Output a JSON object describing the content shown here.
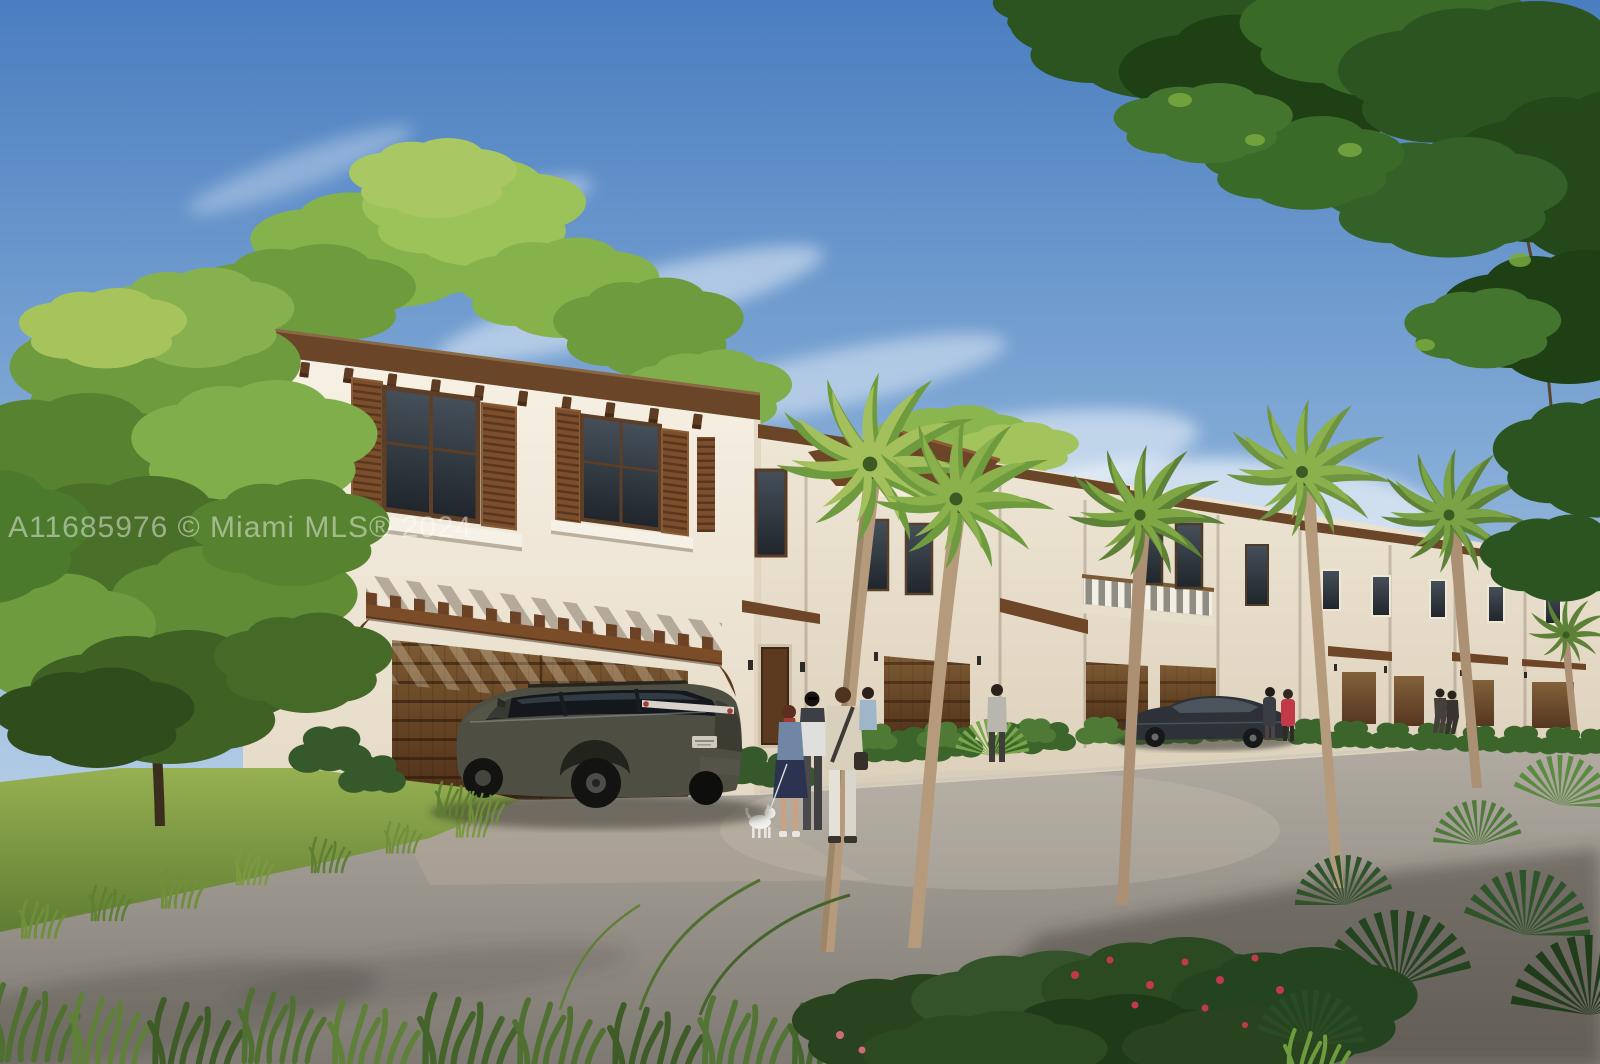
{
  "image": {
    "kind": "real-estate architectural rendering photo",
    "width": 1600,
    "height": 1064,
    "description": "Sunny rendering of a row of two-story Mediterranean-style townhouses with brown shutters, wood pergola over double garage, palm trees, a dark olive SUV parked in the driveway, a group of people with a small white dog, a dark sedan parked further down, green lawn and road in the foreground framed by trees and tropical plants."
  },
  "watermark": {
    "text": "A11685976 © Miami MLS® 2024",
    "color": "#ffffff",
    "opacity": 0.45
  },
  "palette": {
    "sky_top": "#4a7ec0",
    "sky_mid": "#93b7dc",
    "sky_horizon": "#dbe7f1",
    "wall_light": "#f7f1e5",
    "wall_dark": "#e5dac6",
    "wall_shade": "#efe7d7",
    "wall_shade_dark": "#dcd0ba",
    "roof_brown": "#6a4528",
    "roof_dark": "#4e3118",
    "shutter_brown": "#7b4e2c",
    "garage_light": "#7d5a33",
    "garage_dark": "#4e2f18",
    "glass_light": "#46505a",
    "glass_dark": "#1f252b",
    "grass_light": "#97b052",
    "grass_dark": "#5f7d33",
    "road_light": "#b2aca3",
    "road_dark": "#7e7972",
    "foliage_light": "#7fae4a",
    "foliage_dark": "#2c5420",
    "palm_frond": "#84ad4c",
    "trunk_tan": "#b59b7c",
    "suv_body": "#4e4e42",
    "sedan_body": "#2e3238",
    "accent_red": "#c23a4a"
  },
  "scene": {
    "objects": [
      {
        "name": "townhouse-row",
        "desc": "cream stucco two-story townhouses receding right, brown fascia and corbels"
      },
      {
        "name": "upstairs-windows",
        "desc": "dark glass windows with brown louvered shutters"
      },
      {
        "name": "pergola",
        "desc": "wood pergola over double garage casting diagonal shadows"
      },
      {
        "name": "garage-doors",
        "desc": "brown paneled wood garage doors"
      },
      {
        "name": "balcony",
        "desc": "white baluster balcony with wood rail on middle unit"
      },
      {
        "name": "suv",
        "desc": "dark olive SUV parked facing garage"
      },
      {
        "name": "sedan",
        "desc": "dark sedan parked down the lane"
      },
      {
        "name": "people-group",
        "desc": "four adults talking and a small white dog on the driveway"
      },
      {
        "name": "distant-people",
        "desc": "couple by sedan, walking pair near far units"
      },
      {
        "name": "palm-trees",
        "desc": "six curved-trunk palms along the facade"
      },
      {
        "name": "left-tree",
        "desc": "large leafy tree at left edge"
      },
      {
        "name": "overhanging-canopy",
        "desc": "dark green branch canopy framing top right"
      },
      {
        "name": "lawn",
        "desc": "yellow-green lawn strip at left"
      },
      {
        "name": "road",
        "desc": "gray asphalt lane with long shadows"
      },
      {
        "name": "foreground-plants",
        "desc": "grass blades, dark shrubs with red flowers, fan palms bottom right"
      }
    ]
  }
}
